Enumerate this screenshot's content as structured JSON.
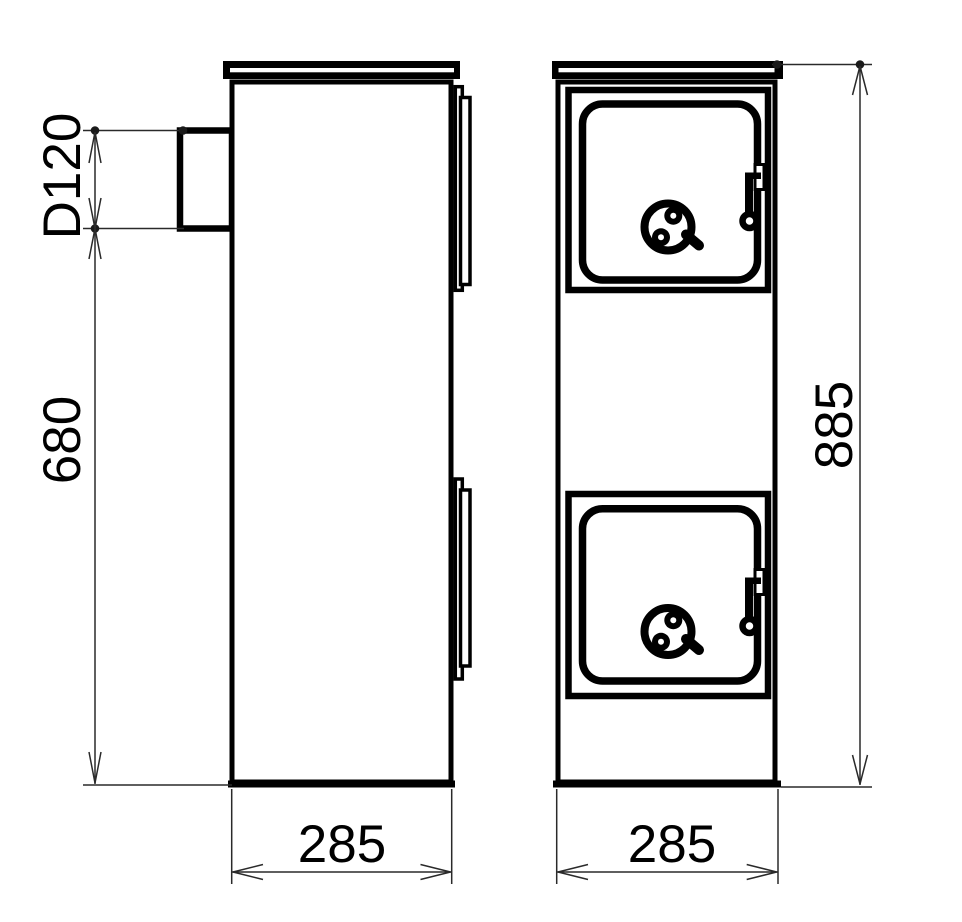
{
  "drawing": {
    "colors": {
      "ink": "#000000",
      "dimension_lines": "#2a2a2a",
      "background": "#ffffff"
    },
    "dimensions": {
      "flue_diameter": "D120",
      "flue_height": "680",
      "side_depth": "285",
      "total_height": "885",
      "front_width": "285"
    }
  }
}
